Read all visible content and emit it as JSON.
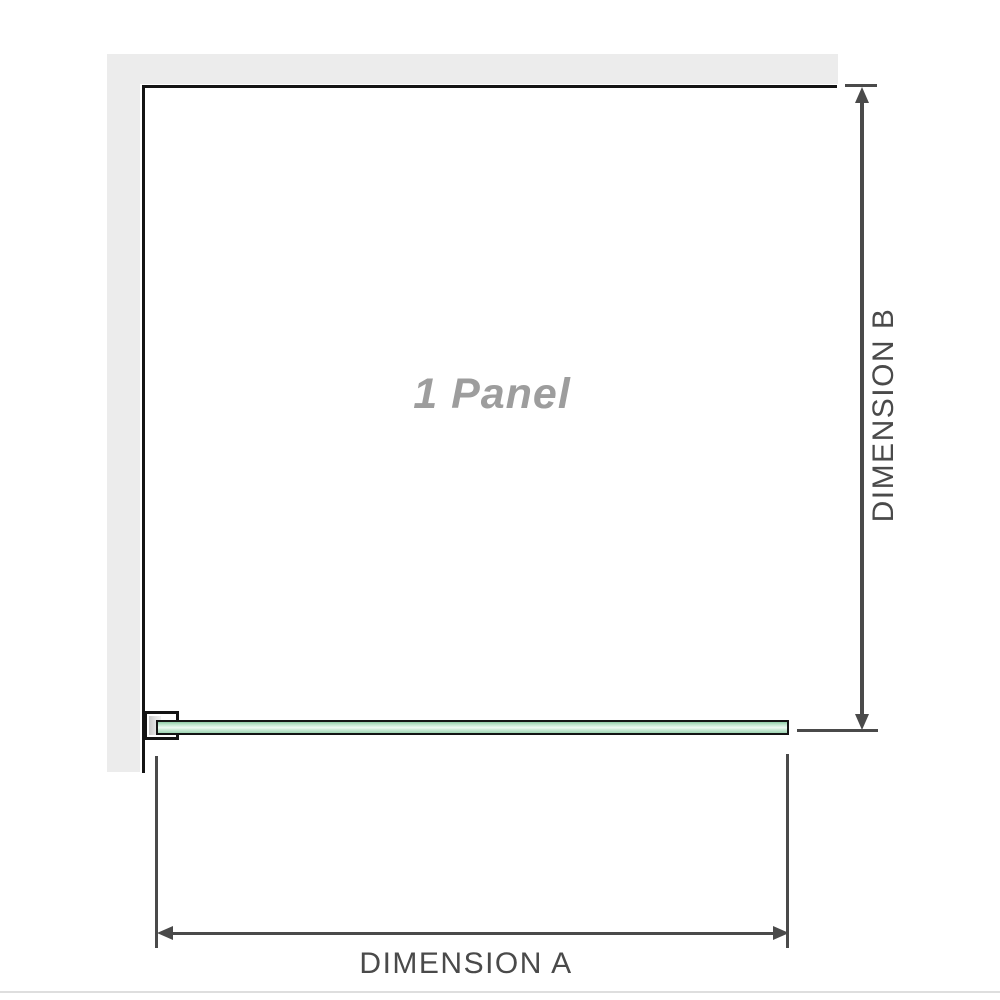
{
  "diagram": {
    "panel_label": "1 Panel",
    "dimension_a_label": "DIMENSION A",
    "dimension_b_label": "DIMENSION B"
  },
  "colors": {
    "background": "#ffffff",
    "wall": "#ececec",
    "outline": "#141414",
    "dimension_line": "#4a4a4a",
    "panel_label_text": "#9d9d9d",
    "glass_green_edge": "#9fd5b3",
    "glass_green_highlight": "#eef9f2",
    "bracket_fill": "#ffffff",
    "bracket_channel_gray": "#c9c9c9",
    "bottom_rule": "#dedede"
  }
}
